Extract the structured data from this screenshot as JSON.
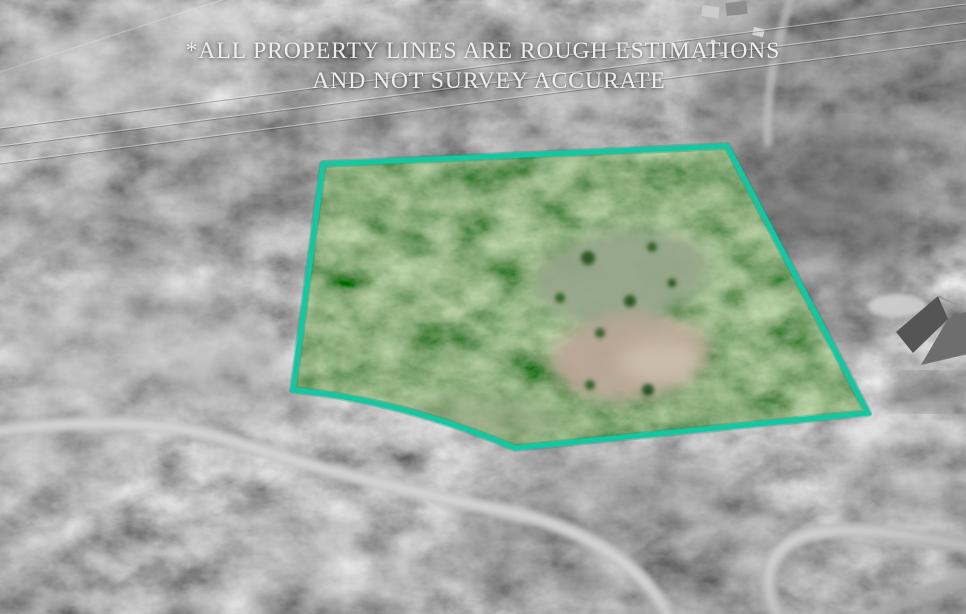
{
  "photo": {
    "kind_label": "aerial-property-photo",
    "description": "Grayscale aerial forest photo with the listed parcel shown in color inside a teal boundary"
  },
  "disclaimer": {
    "line1": "*ALL PROPERTY LINES ARE ROUGH ESTIMATIONS",
    "line2": "AND NOT SURVEY ACCURATE"
  },
  "property_boundary": {
    "stroke_color": "#12c7a1",
    "underglow_color": "#0b9a7c",
    "stroke_width": "5",
    "svg_path": "M 323 164 L 727 146 L 868 413 L 515 448 Q 400 400 293 390 Z"
  },
  "palette": {
    "forest_gray": "#7d7d7d",
    "road_gray": "#c9c9c9",
    "tree_green": "#4d7c3f",
    "meadow_green": "#97a78b",
    "dirt_tan": "#b9a797",
    "text_white": "#f3f3f3"
  },
  "features": {
    "power_lines": "overhead power lines",
    "roads": "gravel roads",
    "house": "neighboring house",
    "meadow": "meadow clearing",
    "dirt": "bare dirt clearing"
  }
}
